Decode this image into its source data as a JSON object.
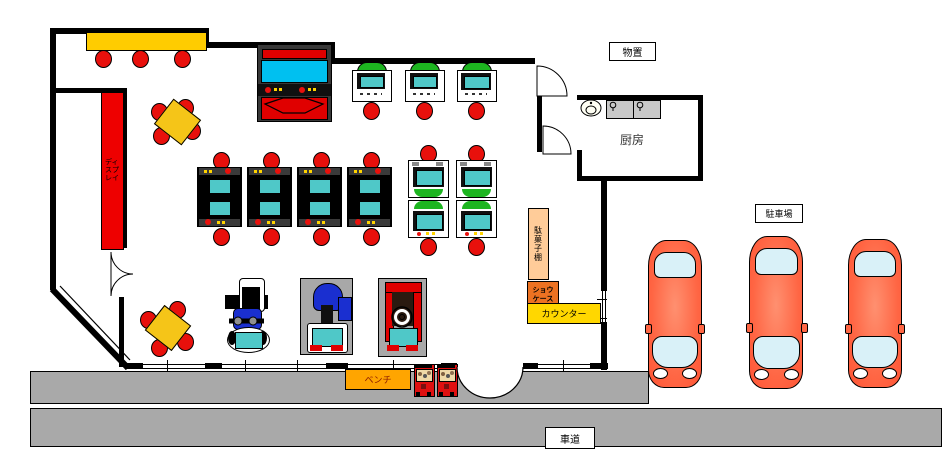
{
  "labels": {
    "storage_room": "物置",
    "kitchen": "厨房",
    "parking_lot": "駐車場",
    "display_shelf": "ディスプレイ",
    "snack_shelf": "駄菓子棚",
    "showcase_line1": "ショウ",
    "showcase_line2": "ケース",
    "counter": "カウンター",
    "bench": "ベンチ",
    "roadway": "車道"
  },
  "colors": {
    "wall": "#000000",
    "floor": "#FFFFFF",
    "pavement_gray": "#A9A9A9",
    "counter_yellow": "#FFD700",
    "table_yellow": "#F5C518",
    "stool_red": "#E8100C",
    "machine_red": "#E00000",
    "screen_cyan": "#4FC8C8",
    "big_screen_blue": "#00C0F0",
    "cabinet_green": "#1DB520",
    "shelf_peach": "#FFCC99",
    "showcase_orange": "#ED7222",
    "bench_orange": "#FFA500",
    "rider_blue": "#1A2FD0",
    "car_orange": "#FF6644",
    "car_window_blue": "#D9F1F8",
    "mat_gray": "#A8A8A8"
  },
  "equipment_counts": {
    "bar_stools": 3,
    "four_seat_tables": 2,
    "large_arcade_cabinet": 1,
    "mini_arcade_cabinets_top_row": 3,
    "table_arcade_units": 8,
    "upright_arcade_cabinets": 4,
    "ride_on_games": 3,
    "capsule_toy_machines": 2,
    "parked_cars": 3
  }
}
